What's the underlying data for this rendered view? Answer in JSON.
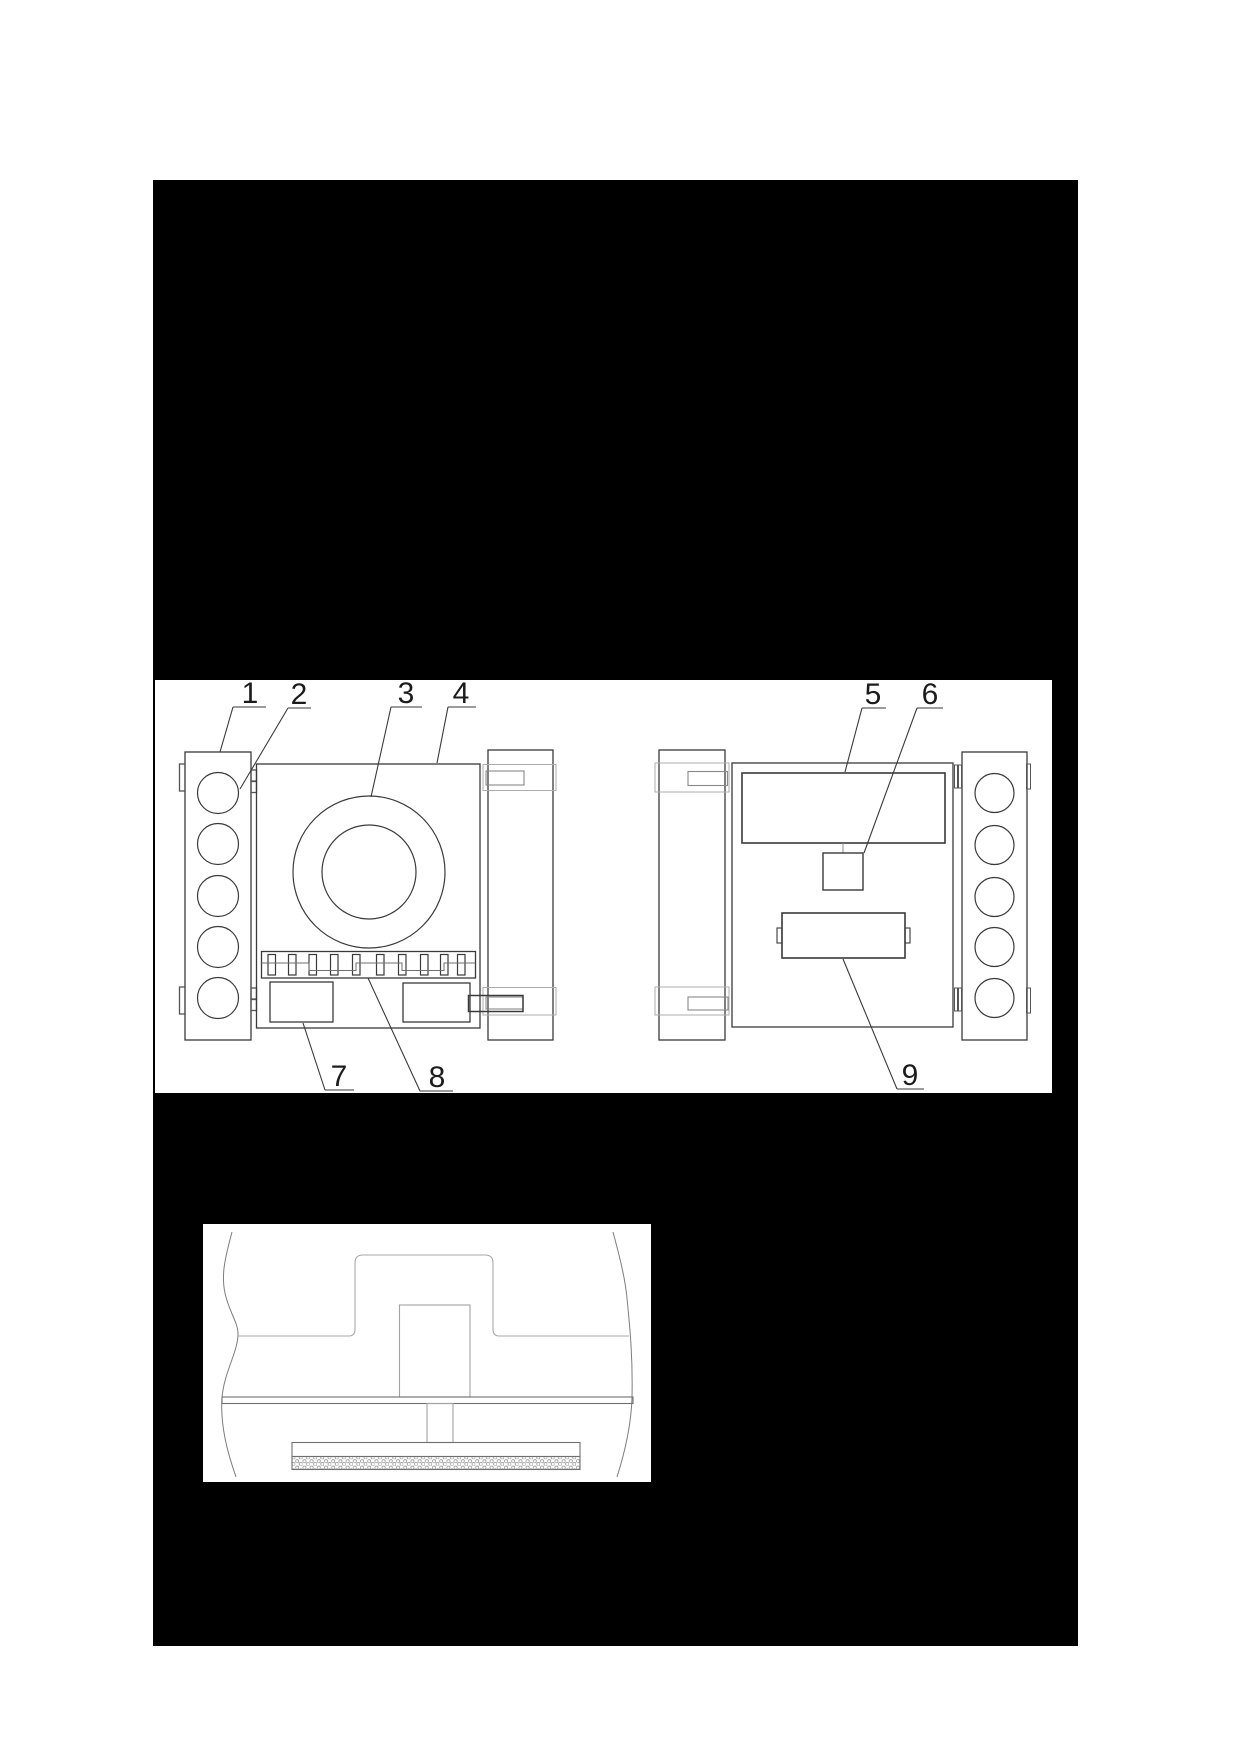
{
  "figure": {
    "type": "patent-style technical line drawing",
    "views": {
      "top_panel": "front and rear views of a tracked device with fan, roller strip, display, camera and battery",
      "detail_panel": "sectional detail of mounting shaft, base plate and textured cleaning pad"
    },
    "reference_labels": [
      "1",
      "2",
      "3",
      "4",
      "5",
      "6",
      "7",
      "8",
      "9"
    ]
  },
  "colors": {
    "page_background": "#ffffff",
    "sheet_background": "#000000",
    "panel_background": "#ffffff",
    "ink_dark": "#3a3a3a",
    "ink_mid": "#757575",
    "ink_light": "#a9a9a9",
    "label_ink": "#1c1c1c"
  }
}
